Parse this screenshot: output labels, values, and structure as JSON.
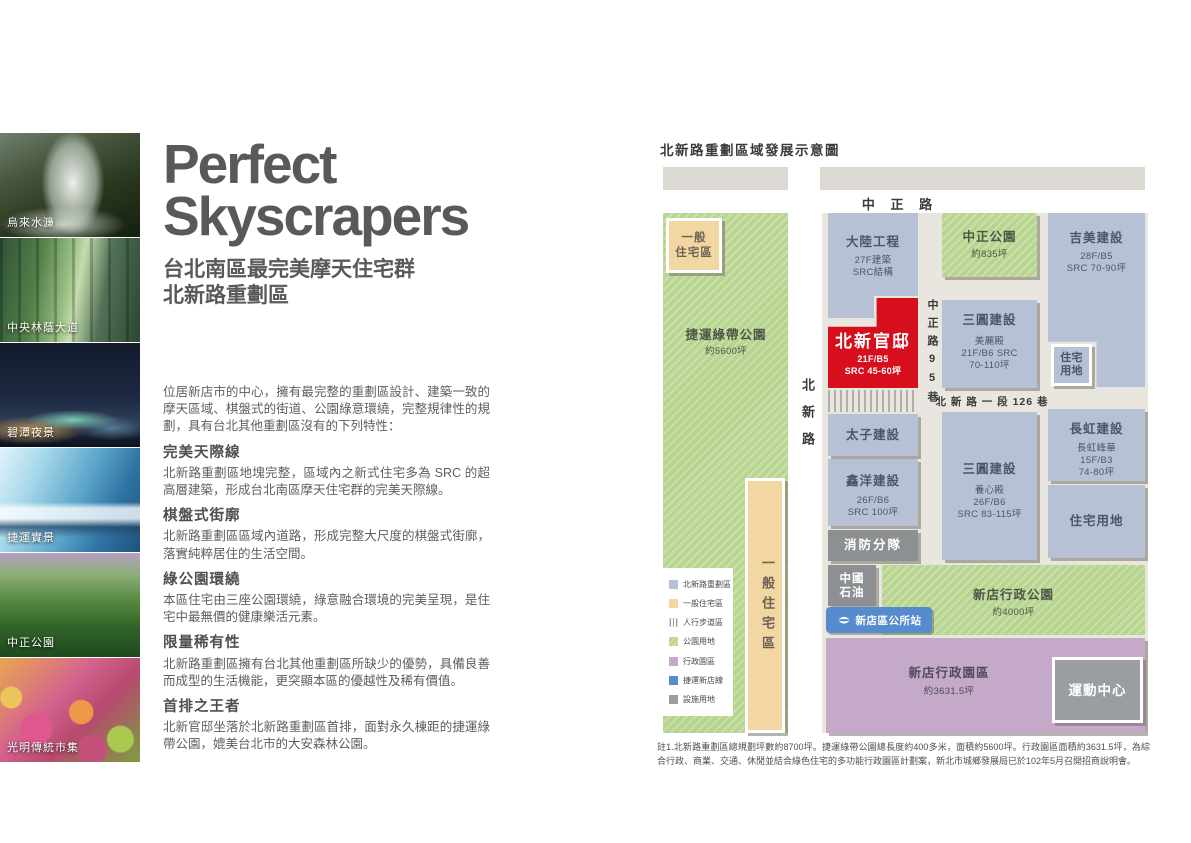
{
  "colors": {
    "accent_red": "#d70f1d",
    "block_blue": "#b6c1d5",
    "park_green": "#b7d491",
    "residential_tan": "#f3d7a2",
    "admin_purple": "#c4a9c9",
    "mrt_blue": "#568cce",
    "facility_gray": "#8d9093",
    "heading_gray": "#58595b"
  },
  "photos": {
    "items": [
      {
        "label": "烏來水濂"
      },
      {
        "label": "中央林蔭大道"
      },
      {
        "label": "碧潭夜景"
      },
      {
        "label": "捷運實景"
      },
      {
        "label": "中正公園"
      },
      {
        "label": "光明傳統市集"
      }
    ]
  },
  "hero": {
    "title_line1": "Perfect",
    "title_line2": "Skyscrapers",
    "subtitle_line1": "台北南區最完美摩天住宅群",
    "subtitle_line2": "北新路重劃區",
    "intro": "位居新店市的中心，擁有最完整的重劃區設計、建築一致的摩天區域、棋盤式的街道、公園綠意環繞，完整規律性的規劃，具有台北其他重劃區沒有的下列特性：",
    "sections": [
      {
        "heading": "完美天際線",
        "body": "北新路重劃區地塊完整，區域內之新式住宅多為 SRC 的超高層建築，形成台北南區摩天住宅群的完美天際線。"
      },
      {
        "heading": "棋盤式街廓",
        "body": "北新路重劃區區域內道路，形成完整大尺度的棋盤式街廓，落實純粹居住的生活空間。"
      },
      {
        "heading": "綠公園環繞",
        "body": "本區住宅由三座公園環繞，綠意融合環境的完美呈現，是住宅中最無價的健康樂活元素。"
      },
      {
        "heading": "限量稀有性",
        "body": "北新路重劃區擁有台北其他重劃區所缺少的優勢，具備良善而成型的生活機能，更突顯本區的優越性及稀有價值。"
      },
      {
        "heading": "首排之王者",
        "body": "北新官邸坐落於北新路重劃區首排，面對永久棟距的捷運綠帶公園，媲美台北市的大安森林公園。"
      }
    ]
  },
  "map": {
    "title": "北新路重劃區域發展示意圖",
    "roads": {
      "zhongzheng": "中 正 路",
      "beixin": "北新路",
      "zhongzheng_lane95": "中正路95巷",
      "beixin_lane126": "北 新 路 一 段 126 巷"
    },
    "areas": {
      "green_belt": {
        "name": "捷運綠帶公園",
        "size": "約5600坪"
      },
      "residential_tl": {
        "line1": "一般",
        "line2": "住宅區"
      },
      "residential_strip": "一般住宅區",
      "zhongzheng_park": {
        "name": "中正公園",
        "size": "約835坪"
      },
      "xindian_admin_park": {
        "name": "新店行政公園",
        "size": "約4000坪"
      },
      "xindian_admin_zone": {
        "name": "新店行政園區",
        "size": "約3631.5坪"
      }
    },
    "blocks": {
      "dalu": {
        "name": "大陸工程",
        "spec1": "27F建築",
        "spec2": "SRC結構"
      },
      "beixin_mansion": {
        "name": "北新官邸",
        "spec1": "21F/B5",
        "spec2": "SRC 45-60坪"
      },
      "sanyuan_meilidian": {
        "name": "三圓建設",
        "sub": "美麗殿",
        "spec1": "21F/B6 SRC",
        "spec2": "70-110坪"
      },
      "jimei": {
        "name": "吉美建設",
        "spec1": "28F/B5",
        "spec2": "SRC 70-90坪"
      },
      "residential_small": {
        "line1": "住宅",
        "line2": "用地"
      },
      "taizi": {
        "name": "太子建設"
      },
      "xinyang": {
        "name": "鑫洋建設",
        "spec1": "26F/B6",
        "spec2": "SRC 100坪"
      },
      "sanyuan_yangxindian": {
        "name": "三圓建設",
        "sub": "養心殿",
        "spec1": "26F/B6",
        "spec2": "SRC 83-115坪"
      },
      "changhong": {
        "name": "長虹建設",
        "sub": "長虹峰華",
        "spec1": "15F/B3",
        "spec2": "74-80坪"
      },
      "residential_big": {
        "name": "住宅用地"
      },
      "fire_station": {
        "name": "消防分隊"
      },
      "cpc": {
        "line1": "中國",
        "line2": "石油"
      },
      "mrt_station": {
        "name": "新店區公所站"
      },
      "sports_center": {
        "name": "運動中心"
      }
    },
    "legend": {
      "items": [
        {
          "label": "北新路重劃區"
        },
        {
          "label": "一般住宅區"
        },
        {
          "label": "人行步道區"
        },
        {
          "label": "公園用地"
        },
        {
          "label": "行政園區"
        },
        {
          "label": "捷運新店線"
        },
        {
          "label": "設施用地"
        }
      ]
    },
    "footnote": "註1.北新路重劃區總規劃坪數約8700坪。捷運綠帶公園總長度約400多米，面積約5600坪。行政園區面積約3631.5坪，為綜合行政、商業、交通、休閒並結合綠色住宅的多功能行政園區計劃案，新北市城鄉發展局已於102年5月召開招商說明會。"
  }
}
